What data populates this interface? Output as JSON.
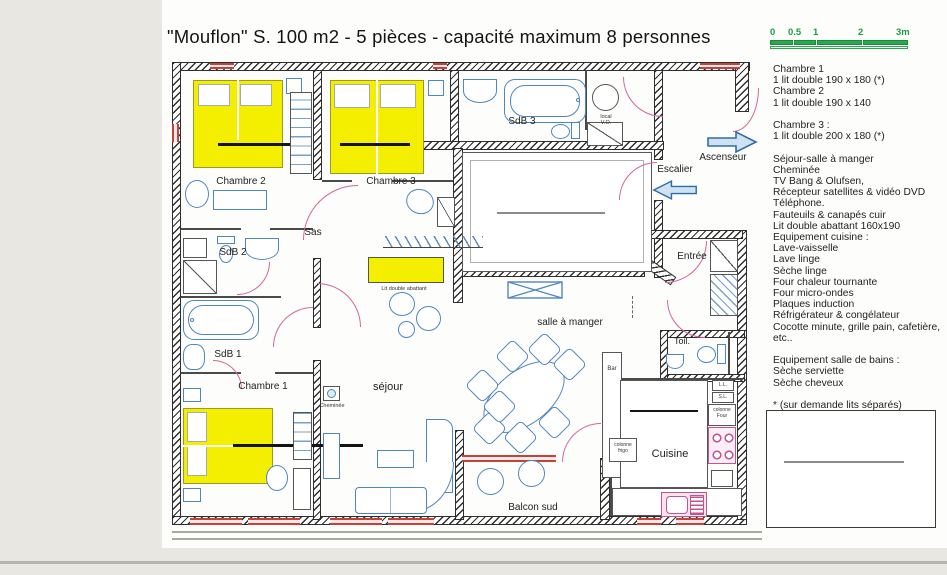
{
  "page": {
    "title": "\"Mouflon\" S. 100  m2 - 5 pièces - capacité maximum 8 personnes"
  },
  "scale_bar": {
    "ticks": [
      "0",
      "0.5",
      "1",
      "2",
      "3m"
    ]
  },
  "plan": {
    "rooms": {
      "chambre_1": "Chambre 1",
      "chambre_2": "Chambre 2",
      "chambre_3": "Chambre 3",
      "sdb_1": "SdB 1",
      "sdb_2": "SdB 2",
      "sdb_3": "SdB 3",
      "sas": "Sas",
      "sejour": "séjour",
      "salle_a_manger": "salle à manger",
      "cuisine": "Cuisine",
      "balcon_sud": "Balcon sud",
      "entree": "Entrée",
      "toilettes": "Toil.",
      "escalier": "Escalier",
      "ascenseur": "Ascenseur"
    },
    "annotations": {
      "local_line1": "local",
      "local_line2": "V.O.",
      "lit_double_abattant": "Lit double abattant",
      "cheminee": "Cheminée",
      "bar": "Bar",
      "colonne_four": "colonne Four",
      "colonne_frigo": "colonne frigo",
      "lave_linge": "L.L.",
      "seche_linge": "S.L."
    }
  },
  "legend": {
    "lines": [
      "Chambre 1",
      "1 lit double 190 x 180 (*)",
      "Chambre 2",
      "1 lit double 190 x 140",
      "",
      "Chambre 3 :",
      "1 lit double 200 x 180 (*)",
      "",
      "Séjour-salle à manger",
      "Cheminée",
      "TV Bang & Olufsen,",
      "Récepteur satellites & vidéo DVD",
      "Téléphone.",
      "Fauteuils & canapés cuir",
      "Lit double abattant 160x190",
      "Equipement cuisine :",
      "Lave-vaisselle",
      "Lave linge",
      "Sèche linge",
      "Four chaleur tournante",
      "Four micro-ondes",
      "Plaques induction",
      "Réfrigérateur & congélateur",
      "Cocotte minute, grille pain, cafetière,",
      "etc..",
      "",
      "Equipement salle de bains :",
      "Sèche serviette",
      "Sèche cheveux",
      "",
      "* (sur demande lits séparés)"
    ]
  },
  "colors": {
    "bed_yellow": "#f4ef00",
    "fixture_blue": "#4e86c0",
    "door_pink": "#d4649b",
    "window_red": "#c0443c",
    "scale_green": "#2aa84f",
    "kitchen_pink": "#c05590",
    "wall_dark": "#2e2e2e"
  }
}
